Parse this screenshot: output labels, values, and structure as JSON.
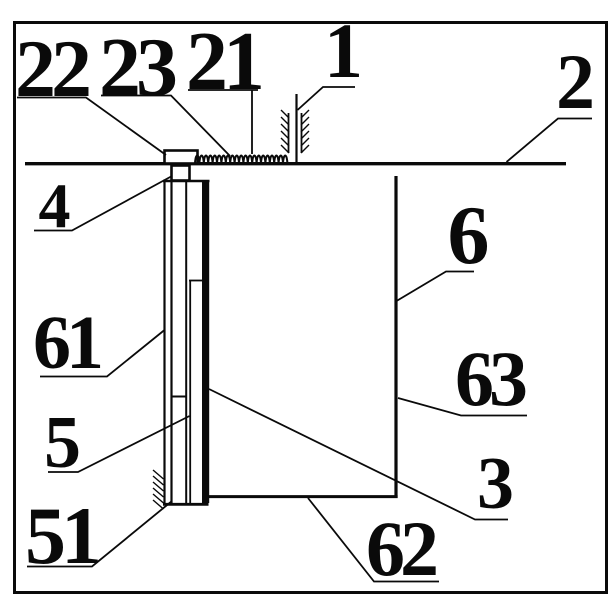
{
  "figure": {
    "type": "patent-line-drawing-sectional-view",
    "background": "#ffffff",
    "ink": "#0a0a0a",
    "part_labels": [
      {
        "text": "22"
      },
      {
        "text": "23"
      },
      {
        "text": "21"
      },
      {
        "text": "1"
      },
      {
        "text": "2"
      },
      {
        "text": "4"
      },
      {
        "text": "6"
      },
      {
        "text": "61"
      },
      {
        "text": "63"
      },
      {
        "text": "5"
      },
      {
        "text": "3"
      },
      {
        "text": "51"
      },
      {
        "text": "62"
      }
    ]
  }
}
